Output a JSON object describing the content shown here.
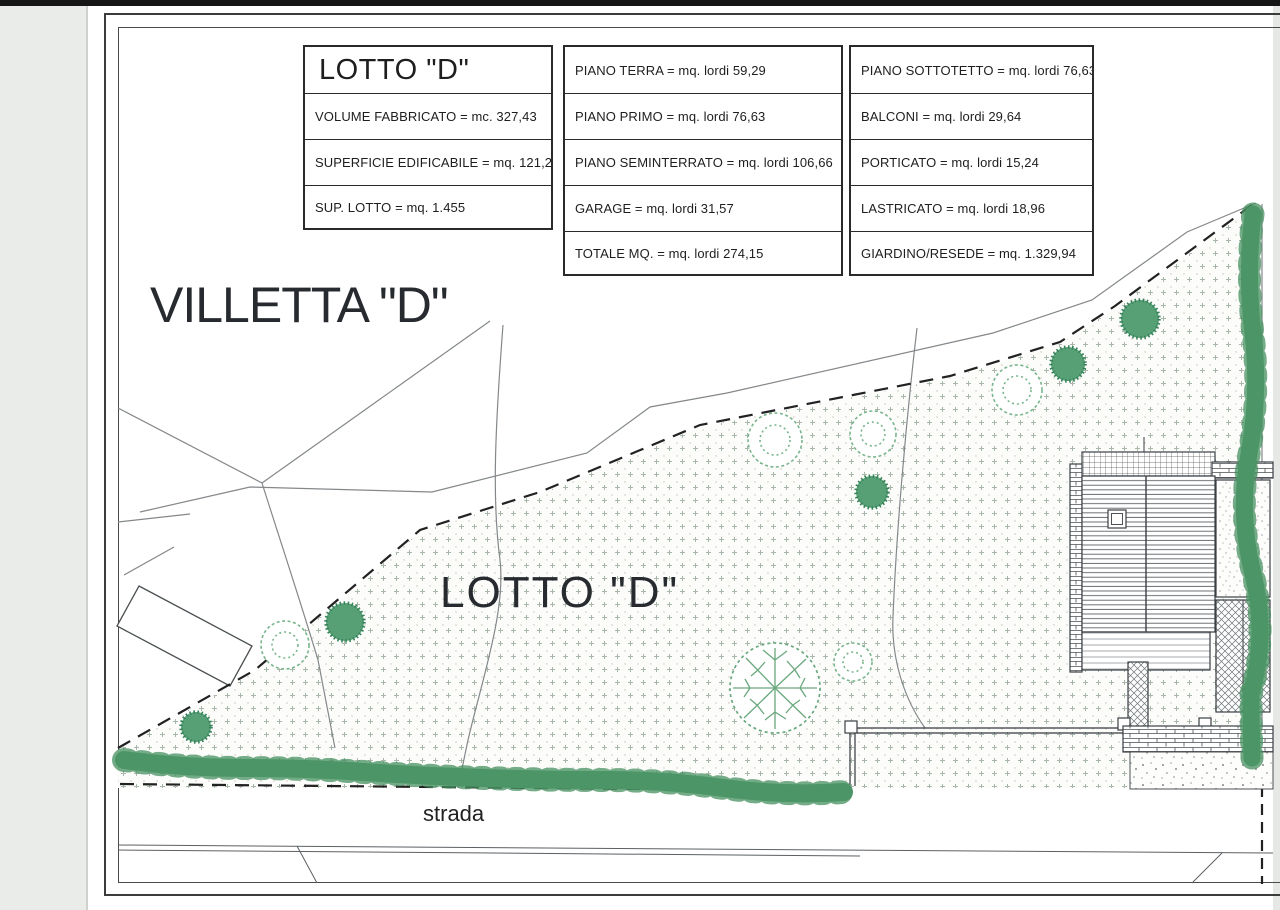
{
  "page": {
    "villetta_title": "VILLETTA \"D\"",
    "plan_label": "LOTTO \"D\"",
    "road_label": "strada"
  },
  "table": {
    "lot": {
      "header": "LOTTO \"D\"",
      "rows": [
        "VOLUME FABBRICATO = mc. 327,43",
        "SUPERFICIE EDIFICABILE = mq. 121,27",
        "SUP. LOTTO = mq. 1.455"
      ]
    },
    "floors": {
      "rows": [
        "PIANO TERRA = mq. lordi 59,29",
        "PIANO PRIMO = mq. lordi 76,63",
        "PIANO SEMINTERRATO = mq. lordi 106,66",
        "GARAGE = mq. lordi 31,57",
        "TOTALE MQ. = mq. lordi 274,15"
      ]
    },
    "extras": {
      "rows": [
        "PIANO SOTTOTETTO = mq. lordi 76,63",
        "BALCONI = mq. lordi 29,64",
        "PORTICATO = mq. lordi 15,24",
        "LASTRICATO = mq. lordi 18,96",
        "GIARDINO/RESEDE = mq. 1.329,94"
      ]
    }
  },
  "colors": {
    "tree_green": "#57a075",
    "hedge_green": "#5ca277",
    "stipple_dot": "#a9b6aa",
    "ink": "#1e1e1e"
  }
}
